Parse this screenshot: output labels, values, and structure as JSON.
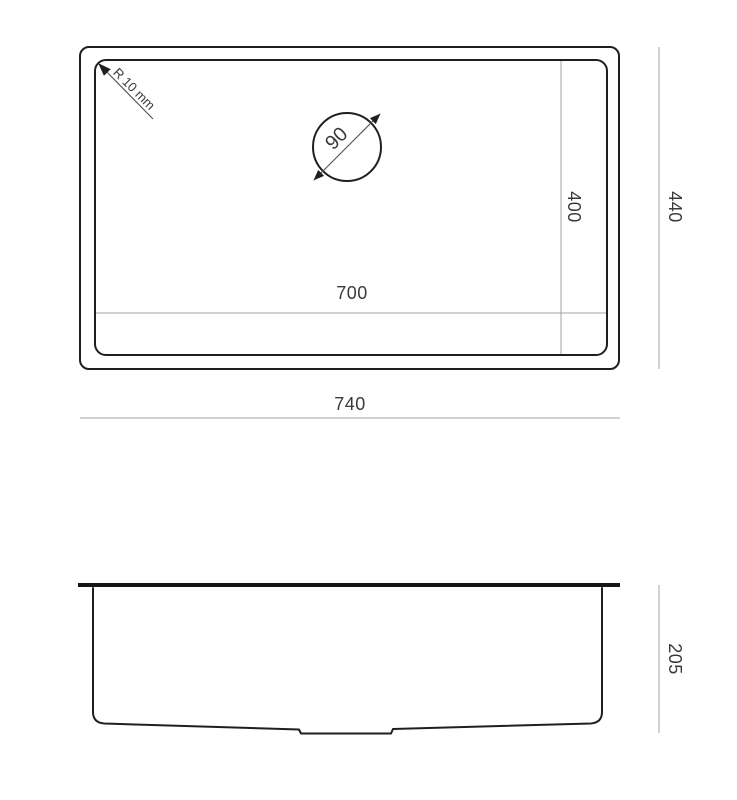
{
  "drawing": {
    "type": "technical-dimension-drawing",
    "subject": "undermount-sink",
    "colors": {
      "background": "#ffffff",
      "outline": "#1f1f1f",
      "dimension_line": "#a3a3a3",
      "label_text": "#3a3a3a"
    },
    "top_view": {
      "outer_width_label": "740",
      "inner_width_label": "700",
      "outer_height_label": "440",
      "inner_height_label": "400",
      "corner_radius_label": "R 10 mm",
      "drain_diameter_label": "90"
    },
    "side_view": {
      "depth_label": "205"
    }
  }
}
